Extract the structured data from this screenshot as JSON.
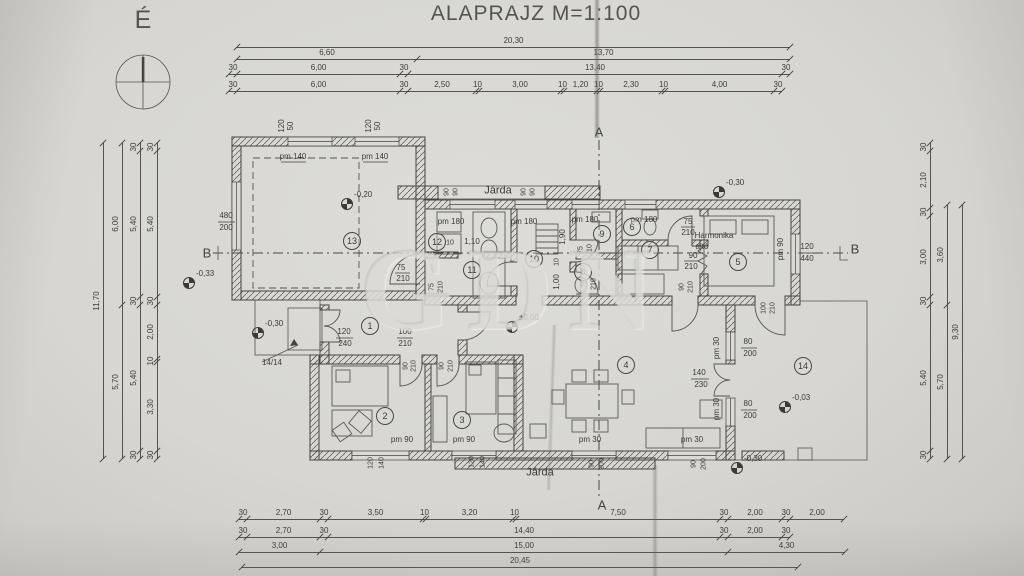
{
  "meta": {
    "title": "ALAPRAJZ M=1:100"
  },
  "north": {
    "label": "É"
  },
  "watermark": {
    "text": "GDN"
  },
  "sections": {
    "a_top": "A",
    "a_bottom": "A",
    "b_left": "B",
    "b_right": "B"
  },
  "rooms": [
    {
      "n": "1",
      "x": 370,
      "y": 326
    },
    {
      "n": "2",
      "x": 385,
      "y": 416
    },
    {
      "n": "3",
      "x": 462,
      "y": 420
    },
    {
      "n": "4",
      "x": 626,
      "y": 365
    },
    {
      "n": "5",
      "x": 738,
      "y": 262
    },
    {
      "n": "6",
      "x": 632,
      "y": 227
    },
    {
      "n": "7",
      "x": 650,
      "y": 250
    },
    {
      "n": "8",
      "x": 583,
      "y": 272
    },
    {
      "n": "9",
      "x": 602,
      "y": 234
    },
    {
      "n": "10",
      "x": 534,
      "y": 259
    },
    {
      "n": "11",
      "x": 472,
      "y": 270
    },
    {
      "n": "12",
      "x": 437,
      "y": 242
    },
    {
      "n": "13",
      "x": 352,
      "y": 241
    },
    {
      "n": "14",
      "x": 803,
      "y": 366
    }
  ],
  "levels": [
    {
      "t": "-0,20",
      "x": 347,
      "y": 204
    },
    {
      "t": "-0,30",
      "x": 719,
      "y": 192
    },
    {
      "t": "-0,33",
      "x": 189,
      "y": 283
    },
    {
      "t": "-0,30",
      "x": 258,
      "y": 333
    },
    {
      "t": "±0,00",
      "x": 512,
      "y": 327
    },
    {
      "t": "-0,03",
      "x": 785,
      "y": 407
    },
    {
      "t": "-0,30",
      "x": 737,
      "y": 468
    }
  ],
  "dim_rows": [
    {
      "o": "h",
      "y": 47,
      "segs": [
        [
          "20,30",
          237,
          790
        ]
      ]
    },
    {
      "o": "h",
      "y": 59,
      "segs": [
        [
          "6,60",
          237,
          417
        ],
        [
          "13,70",
          417,
          790
        ]
      ]
    },
    {
      "o": "h",
      "y": 74,
      "segs": [
        [
          "30",
          229,
          237
        ],
        [
          "6,00",
          237,
          400
        ],
        [
          "30",
          400,
          408
        ],
        [
          "13,40",
          408,
          782
        ],
        [
          "30",
          782,
          790
        ]
      ]
    },
    {
      "o": "h",
      "y": 91,
      "segs": [
        [
          "30",
          229,
          237
        ],
        [
          "6,00",
          237,
          400
        ],
        [
          "30",
          400,
          408
        ],
        [
          "2,50",
          408,
          476
        ],
        [
          "10",
          476,
          479
        ],
        [
          "3,00",
          479,
          561
        ],
        [
          "10",
          561,
          564
        ],
        [
          "1,20",
          564,
          597
        ],
        [
          "10",
          597,
          600
        ],
        [
          "2,30",
          600,
          662
        ],
        [
          "10",
          662,
          665
        ],
        [
          "4,00",
          665,
          774
        ],
        [
          "30",
          774,
          782
        ]
      ]
    },
    {
      "o": "h",
      "y": 519,
      "segs": [
        [
          "30",
          239,
          247
        ],
        [
          "2,70",
          247,
          320
        ],
        [
          "30",
          320,
          328
        ],
        [
          "3,50",
          328,
          423
        ],
        [
          "10",
          423,
          426
        ],
        [
          "3,20",
          426,
          513
        ],
        [
          "10",
          513,
          516
        ],
        [
          "7,50",
          516,
          720
        ],
        [
          "30",
          720,
          728
        ],
        [
          "2,00",
          728,
          782
        ],
        [
          "30",
          782,
          790
        ],
        [
          "2,00",
          790,
          844
        ]
      ]
    },
    {
      "o": "h",
      "y": 537,
      "segs": [
        [
          "30",
          239,
          247
        ],
        [
          "2,70",
          247,
          320
        ],
        [
          "30",
          320,
          328
        ],
        [
          "14,40",
          328,
          720
        ],
        [
          "30",
          720,
          728
        ],
        [
          "2,00",
          728,
          782
        ],
        [
          "30",
          782,
          790
        ]
      ]
    },
    {
      "o": "h",
      "y": 552,
      "segs": [
        [
          "3,00",
          239,
          320
        ],
        [
          "15,00",
          320,
          728
        ],
        [
          "4,30",
          728,
          845
        ]
      ]
    },
    {
      "o": "h",
      "y": 567,
      "segs": [
        [
          "20,45",
          242,
          798
        ]
      ]
    },
    {
      "o": "v",
      "x": 103,
      "segs": [
        [
          "11,70",
          143,
          459
        ]
      ]
    },
    {
      "o": "v",
      "x": 122,
      "segs": [
        [
          "6,00",
          143,
          305
        ],
        [
          "5,70",
          305,
          459
        ]
      ]
    },
    {
      "o": "v",
      "x": 140,
      "segs": [
        [
          "30",
          143,
          151
        ],
        [
          "5,40",
          151,
          297
        ],
        [
          "30",
          297,
          305
        ],
        [
          "5,40",
          305,
          451
        ],
        [
          "30",
          451,
          459
        ]
      ]
    },
    {
      "o": "v",
      "x": 157,
      "segs": [
        [
          "30",
          143,
          151
        ],
        [
          "5,40",
          151,
          297
        ],
        [
          "30",
          297,
          305
        ],
        [
          "2,00",
          305,
          359
        ],
        [
          "10",
          359,
          362
        ],
        [
          "3,30",
          362,
          451
        ],
        [
          "30",
          451,
          459
        ]
      ]
    },
    {
      "o": "v",
      "x": 930,
      "segs": [
        [
          "30",
          143,
          151
        ],
        [
          "2,10",
          151,
          208
        ],
        [
          "30",
          208,
          216
        ],
        [
          "3,00",
          216,
          297
        ],
        [
          "30",
          297,
          305
        ],
        [
          "5,40",
          305,
          451
        ],
        [
          "30",
          451,
          459
        ]
      ]
    },
    {
      "o": "v",
      "x": 947,
      "segs": [
        [
          "3,60",
          205,
          305
        ],
        [
          "5,70",
          305,
          459
        ]
      ]
    },
    {
      "o": "v",
      "x": 962,
      "segs": [
        [
          "9,30",
          205,
          459
        ]
      ]
    }
  ],
  "plan_labels": [
    {
      "t": "120",
      "x": 282,
      "y": 126,
      "r": -90
    },
    {
      "t": "50",
      "x": 291,
      "y": 126,
      "r": -90
    },
    {
      "t": "pm 140",
      "x": 293,
      "y": 157
    },
    {
      "t": "120",
      "x": 369,
      "y": 126,
      "r": -90
    },
    {
      "t": "50",
      "x": 378,
      "y": 126,
      "r": -90
    },
    {
      "t": "pm 140",
      "x": 375,
      "y": 157
    },
    {
      "t": "480",
      "x": 226,
      "y": 216
    },
    {
      "t": "200",
      "x": 226,
      "y": 228
    },
    {
      "t": "75",
      "x": 401,
      "y": 268
    },
    {
      "t": "210",
      "x": 403,
      "y": 279
    },
    {
      "t": "Járda",
      "x": 498,
      "y": 191,
      "s": 11
    },
    {
      "t": "90",
      "x": 447,
      "y": 192,
      "r": -90,
      "s": 7
    },
    {
      "t": "90",
      "x": 456,
      "y": 192,
      "r": -90,
      "s": 7
    },
    {
      "t": "90",
      "x": 524,
      "y": 192,
      "r": -90,
      "s": 7
    },
    {
      "t": "90",
      "x": 533,
      "y": 192,
      "r": -90,
      "s": 7
    },
    {
      "t": "pm 180",
      "x": 451,
      "y": 222
    },
    {
      "t": "pm 180",
      "x": 524,
      "y": 222
    },
    {
      "t": "pm 180",
      "x": 585,
      "y": 220
    },
    {
      "t": "pm 180",
      "x": 644,
      "y": 220
    },
    {
      "t": "10",
      "x": 450,
      "y": 243,
      "s": 7
    },
    {
      "t": "1,10",
      "x": 472,
      "y": 242
    },
    {
      "t": "1,90",
      "x": 563,
      "y": 237,
      "r": -90
    },
    {
      "t": "10",
      "x": 557,
      "y": 262,
      "r": -90,
      "s": 7
    },
    {
      "t": "1,00",
      "x": 557,
      "y": 282,
      "r": -90
    },
    {
      "t": "75",
      "x": 432,
      "y": 287,
      "r": -90,
      "s": 7
    },
    {
      "t": "210",
      "x": 441,
      "y": 287,
      "r": -90,
      "s": 7
    },
    {
      "t": "75",
      "x": 581,
      "y": 250,
      "r": -90,
      "s": 7
    },
    {
      "t": "210",
      "x": 590,
      "y": 250,
      "r": -90,
      "s": 7
    },
    {
      "t": "75",
      "x": 585,
      "y": 284,
      "r": -90,
      "s": 7
    },
    {
      "t": "210",
      "x": 594,
      "y": 284,
      "r": -90,
      "s": 7
    },
    {
      "t": "75",
      "x": 688,
      "y": 222
    },
    {
      "t": "210",
      "x": 688,
      "y": 233
    },
    {
      "t": "Harmonika",
      "x": 714,
      "y": 236
    },
    {
      "t": "ajtó",
      "x": 702,
      "y": 247
    },
    {
      "t": "90",
      "x": 693,
      "y": 256
    },
    {
      "t": "210",
      "x": 691,
      "y": 267
    },
    {
      "t": "pm 90",
      "x": 781,
      "y": 249,
      "r": -90
    },
    {
      "t": "120",
      "x": 807,
      "y": 247
    },
    {
      "t": "440",
      "x": 807,
      "y": 259
    },
    {
      "t": "120",
      "x": 344,
      "y": 332
    },
    {
      "t": "240",
      "x": 345,
      "y": 344
    },
    {
      "t": "100",
      "x": 405,
      "y": 332
    },
    {
      "t": "210",
      "x": 405,
      "y": 344
    },
    {
      "t": "90",
      "x": 406,
      "y": 366,
      "r": -90,
      "s": 7
    },
    {
      "t": "210",
      "x": 414,
      "y": 366,
      "r": -90,
      "s": 7
    },
    {
      "t": "90",
      "x": 442,
      "y": 366,
      "r": -90,
      "s": 7
    },
    {
      "t": "210",
      "x": 451,
      "y": 366,
      "r": -90,
      "s": 7
    },
    {
      "t": "14/14",
      "x": 272,
      "y": 363
    },
    {
      "t": "pm 90",
      "x": 402,
      "y": 440
    },
    {
      "t": "120",
      "x": 371,
      "y": 463,
      "r": -90,
      "s": 7
    },
    {
      "t": "140",
      "x": 382,
      "y": 463,
      "r": -90,
      "s": 7
    },
    {
      "t": "pm 90",
      "x": 464,
      "y": 440
    },
    {
      "t": "120",
      "x": 472,
      "y": 462,
      "r": -90,
      "s": 7
    },
    {
      "t": "140",
      "x": 483,
      "y": 462,
      "r": -90,
      "s": 7
    },
    {
      "t": "Járda",
      "x": 540,
      "y": 473,
      "s": 11
    },
    {
      "t": "pm 30",
      "x": 590,
      "y": 440
    },
    {
      "t": "90",
      "x": 592,
      "y": 464,
      "r": -90,
      "s": 7
    },
    {
      "t": "200",
      "x": 602,
      "y": 464,
      "r": -90,
      "s": 7
    },
    {
      "t": "pm 30",
      "x": 692,
      "y": 440
    },
    {
      "t": "90",
      "x": 694,
      "y": 464,
      "r": -90,
      "s": 7
    },
    {
      "t": "200",
      "x": 704,
      "y": 464,
      "r": -90,
      "s": 7
    },
    {
      "t": "pm 30",
      "x": 717,
      "y": 348,
      "r": -90
    },
    {
      "t": "80",
      "x": 748,
      "y": 342
    },
    {
      "t": "200",
      "x": 750,
      "y": 354
    },
    {
      "t": "140",
      "x": 699,
      "y": 373
    },
    {
      "t": "230",
      "x": 701,
      "y": 385
    },
    {
      "t": "pm 30",
      "x": 717,
      "y": 409,
      "r": -90
    },
    {
      "t": "80",
      "x": 748,
      "y": 404
    },
    {
      "t": "200",
      "x": 750,
      "y": 416
    },
    {
      "t": "100",
      "x": 764,
      "y": 308,
      "r": -90,
      "s": 7
    },
    {
      "t": "210",
      "x": 773,
      "y": 308,
      "r": -90,
      "s": 7
    },
    {
      "t": "90",
      "x": 682,
      "y": 287,
      "r": -90,
      "s": 7
    },
    {
      "t": "210",
      "x": 691,
      "y": 287,
      "r": -90,
      "s": 7
    }
  ]
}
